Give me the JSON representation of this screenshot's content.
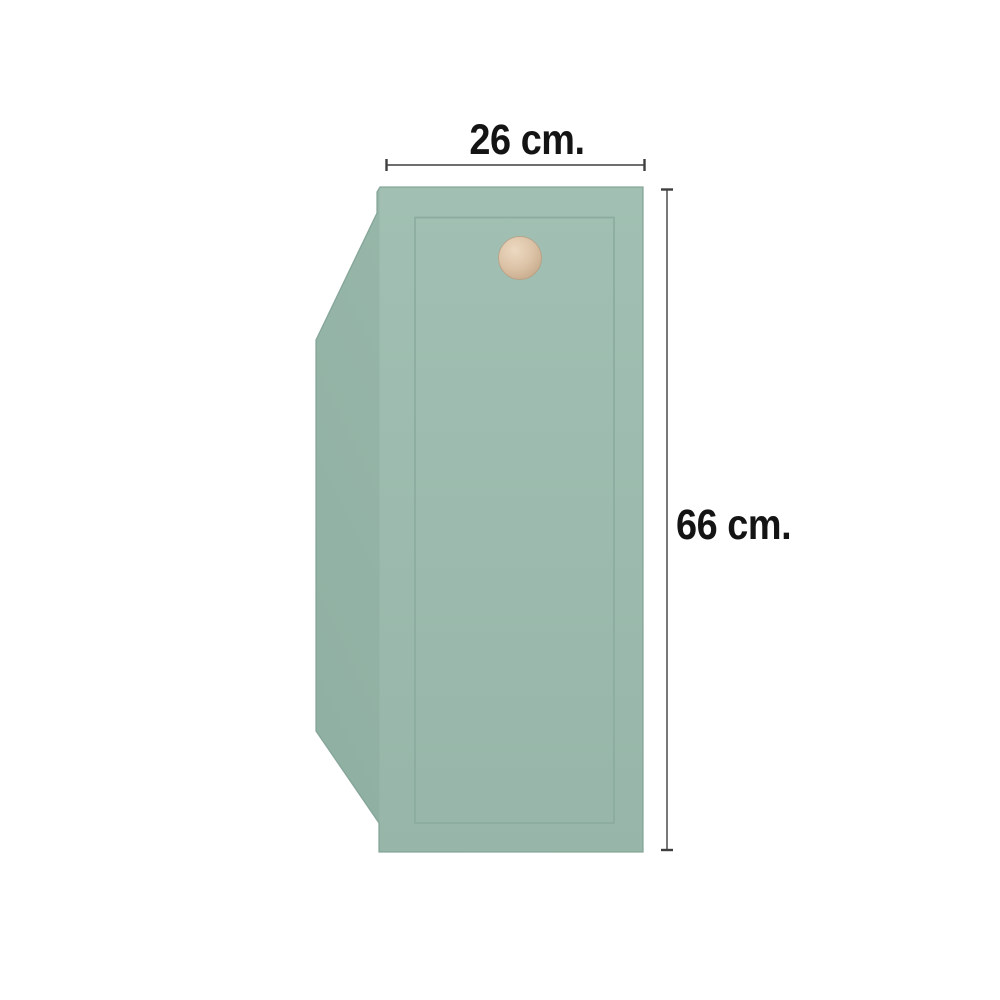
{
  "diagram": {
    "type": "product-dimension-diagram",
    "product": "cabinet-door-panel-with-knob",
    "dimensions": {
      "width": {
        "value": 26,
        "unit": "cm",
        "label": "26 cm."
      },
      "height": {
        "value": 66,
        "unit": "cm",
        "label": "66 cm."
      }
    },
    "colors": {
      "background": "#ffffff",
      "front_top": "#a1c0b3",
      "front_bottom": "#97b6a9",
      "side_light": "#9cbbae",
      "side_dark": "#8fafa2",
      "panel_edge": "#7fa194",
      "inner_line": "#8aab9e",
      "knob_light": "#ecd9c1",
      "knob_mid": "#dcc3a7",
      "knob_dark": "#c5a788",
      "knob_rim": "#b79a7e",
      "dimension_line": "#3f3f3f",
      "label_text": "#141414"
    }
  }
}
